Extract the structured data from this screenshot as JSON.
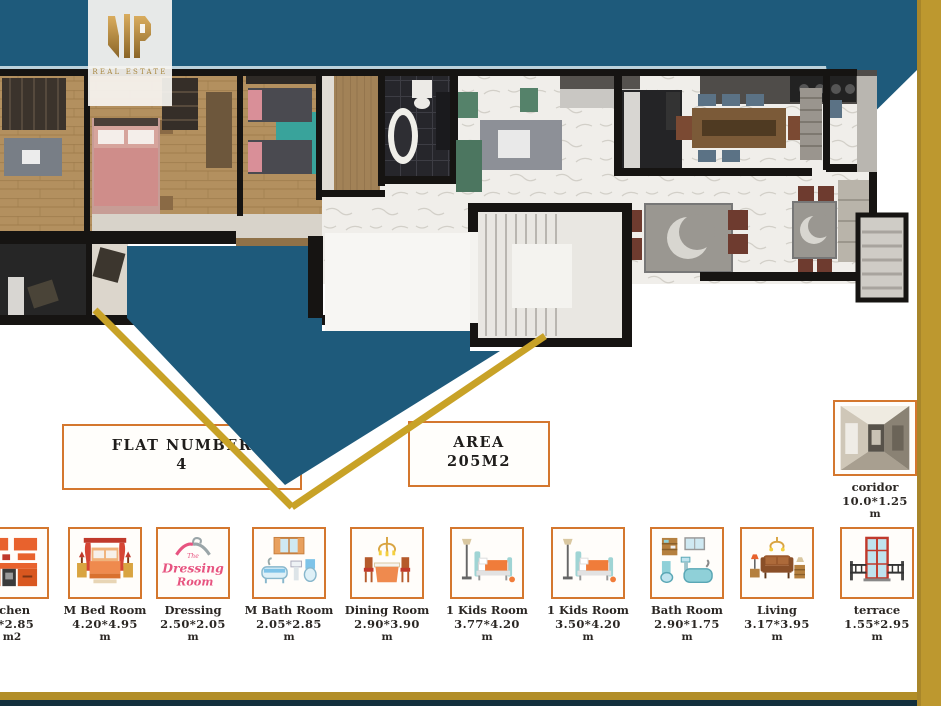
{
  "header": {
    "logo_monogram": "VIP",
    "logo_subtitle": "REAL ESTATE"
  },
  "flat_box": {
    "line1": "FLAT NUMBER",
    "line2": "4"
  },
  "area_box": {
    "line1": "AREA",
    "line2": "205M2"
  },
  "corridor_tile": {
    "name": "coridor",
    "dimensions": "10.0*1.25",
    "unit": "m",
    "icon": "corridor-photo-icon"
  },
  "room_tiles": [
    {
      "name": "tchen",
      "dimensions": "5*2.85",
      "unit": "m2",
      "icon": "kitchen-icon"
    },
    {
      "name": "M Bed Room",
      "dimensions": "4.20*4.95",
      "unit": "m",
      "icon": "master-bed-icon"
    },
    {
      "name": "Dressing",
      "dimensions": "2.50*2.05",
      "unit": "m",
      "icon": "dressing-room-icon"
    },
    {
      "name": "M Bath Room",
      "dimensions": "2.05*2.85",
      "unit": "m",
      "icon": "master-bath-icon"
    },
    {
      "name": "Dining Room",
      "dimensions": "2.90*3.90",
      "unit": "m",
      "icon": "dining-room-icon"
    },
    {
      "name": "1 Kids Room",
      "dimensions": "3.77*4.20",
      "unit": "m",
      "icon": "kids-bed-icon"
    },
    {
      "name": "1 Kids Room",
      "dimensions": "3.50*4.20",
      "unit": "m",
      "icon": "kids-bed-icon"
    },
    {
      "name": "Bath Room",
      "dimensions": "2.90*1.75",
      "unit": "m",
      "icon": "bath-icon"
    },
    {
      "name": "Living",
      "dimensions": "3.17*3.95",
      "unit": "m",
      "icon": "living-sofa-icon"
    },
    {
      "name": "terrace",
      "dimensions": "1.55*2.95",
      "unit": "m",
      "icon": "terrace-door-icon"
    }
  ],
  "dressing_logo": {
    "line1": "The",
    "line2": "Dressing",
    "line3": "Room"
  },
  "colors": {
    "teal": "#1e5a7b",
    "gold_stripe": "#bd982f",
    "gold_line": "#c8a227",
    "bottom_bar_gold": "#b28e28",
    "bottom_bar_navy": "#13303d",
    "tile_border": "#d4772e",
    "logo_gold": "#b08d55"
  }
}
